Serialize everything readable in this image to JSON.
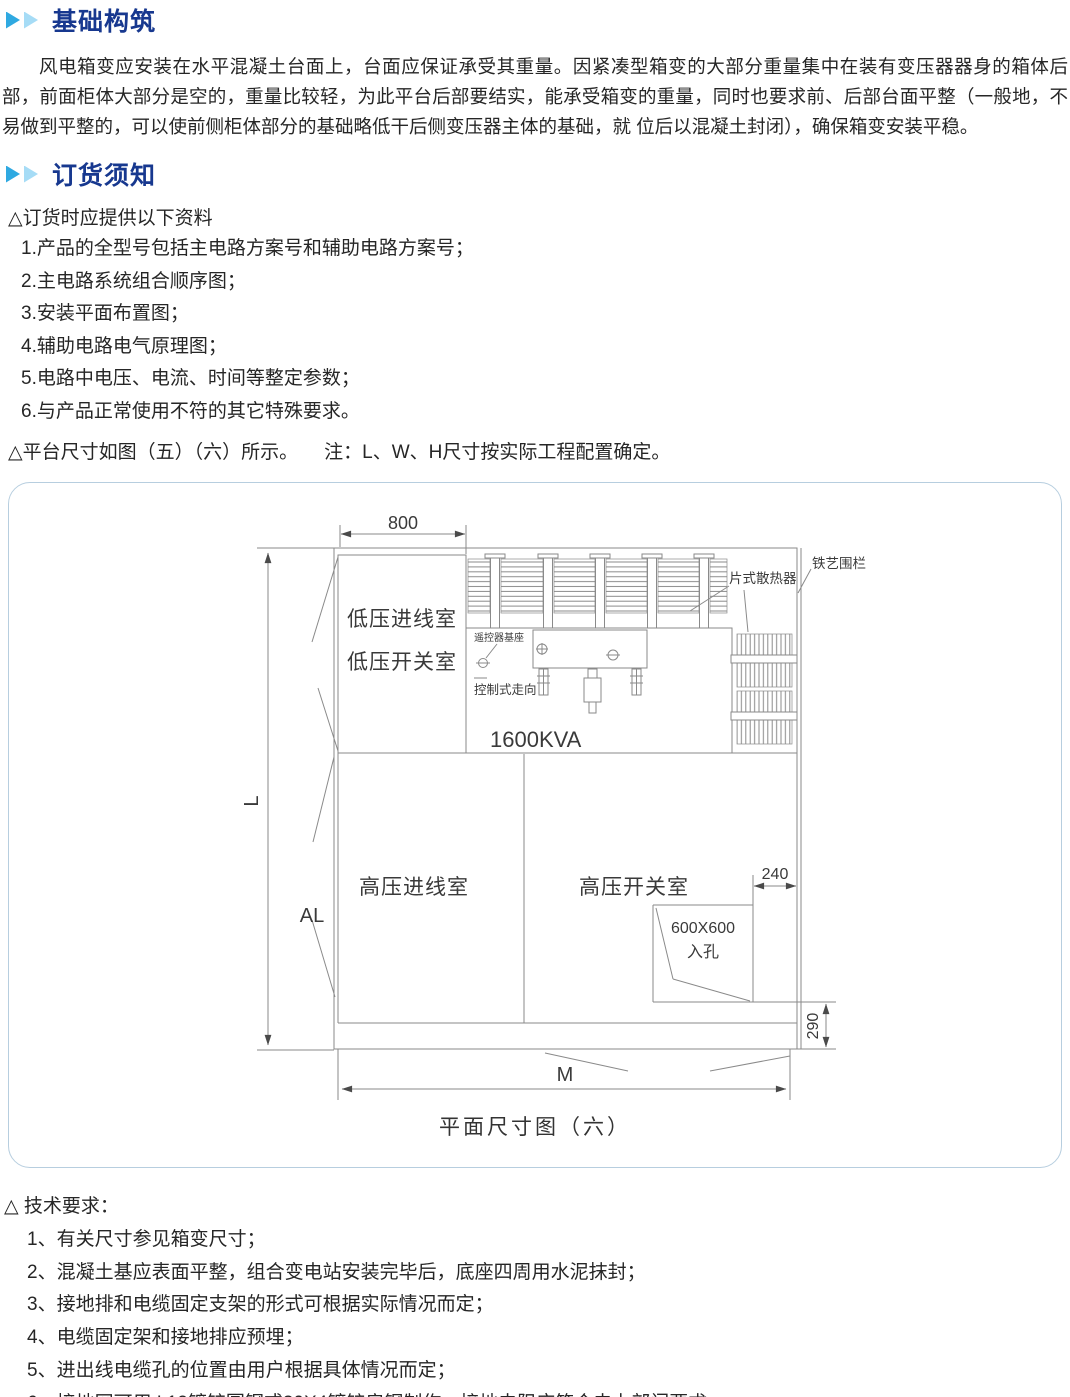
{
  "colors": {
    "heading_blue": "#17388f",
    "arrow_blue": "#2fa9e1",
    "arrow_light_blue": "#a6dcf6",
    "figure_border": "#b7cedf",
    "cad_line": "#8a8a8a"
  },
  "foundation": {
    "title": "基础构筑",
    "paragraph": "风电箱变应安装在水平混凝土台面上，台面应保证承受其重量。因紧凑型箱变的大部分重量集中在装有变压器器身的箱体后部，前面柜体大部分是空的，重量比较轻，为此平台后部要结实，能承受箱变的重量，同时也要求前、后部台面平整（一般地，不易做到平整的，可以使前侧柜体部分的基础略低干后侧变压器主体的基础，就 位后以混凝土封闭），确保箱变安装平稳。"
  },
  "ordering": {
    "title": "订货须知",
    "intro": "△订货时应提供以下资料",
    "items": [
      "1.产品的全型号包括主电路方案号和辅助电路方案号；",
      "2.主电路系统组合顺序图；",
      "3.安装平面布置图；",
      "4.辅助电路电气原理图；",
      "5.电路中电压、电流、时间等整定参数；",
      "6.与产品正常使用不符的其它特殊要求。"
    ],
    "platform_note": "△平台尺寸如图（五）（六）所示。",
    "platform_note_remark": "注：L、W、H尺寸按实际工程配置确定。"
  },
  "figure": {
    "caption": "平面尺寸图（六）",
    "rooms": {
      "lv_incoming": "低压进线室",
      "lv_switch": "低压开关室",
      "hv_incoming": "高压进线室",
      "hv_switch": "高压开关室"
    },
    "transformer_rating": "1600KVA",
    "labels": {
      "plate_radiator": "片式散热器",
      "iron_fence": "铁艺围栏",
      "remote_base": "遥控器基座",
      "control_route": "控制式走向",
      "manhole_size": "600X600",
      "manhole_name": "入孔"
    },
    "dimensions": {
      "top_width": "800",
      "left_total": "L",
      "left_al": "AL",
      "bottom_width": "M",
      "manhole_offset": "240",
      "rear_depth": "290"
    }
  },
  "technical": {
    "title": "△ 技术要求：",
    "items": [
      "1、有关尺寸参见箱变尺寸；",
      "2、混凝土基应表面平整，组合变电站安装完毕后，底座四周用水泥抹封；",
      "3、接地排和电缆固定支架的形式可根据实际情况而定；",
      "4、电缆固定架和接地排应预埋；",
      "5、进出线电缆孔的位置由用户根据具体情况而定；",
      "6、接地网可用Φ12镀锌圆钢或30X4镀锌扁钢制作，接地电阻应符合电力部门要求。"
    ]
  }
}
